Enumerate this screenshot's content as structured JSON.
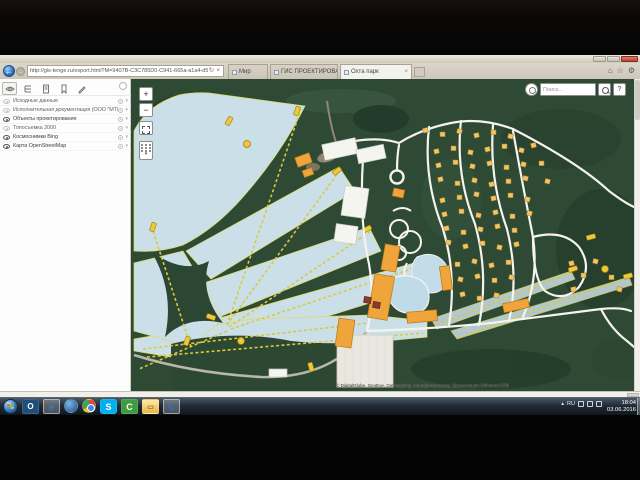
{
  "browser": {
    "back_icon": "←",
    "forward_icon": "→",
    "url": "http://gis-tenge.ru/export.html?M=9407B-C3C785D0-C941-665a-a1a4-d55b90ba77aa48bc65",
    "refresh_icon": "↻",
    "stop_icon": "×",
    "tabs": [
      {
        "label": "Мир"
      },
      {
        "label": "ГИС ПРОЕКТИРОВАНИЕ"
      },
      {
        "label": "Охта парк",
        "close_icon": "×"
      }
    ],
    "toolbar": {
      "home_icon": "⌂",
      "favorites_icon": "☆",
      "tools_icon": "⚙"
    }
  },
  "sidebar": {
    "tools": [
      {
        "name": "visibility"
      },
      {
        "name": "legend"
      },
      {
        "name": "documents"
      },
      {
        "name": "bookmarks"
      },
      {
        "name": "edit"
      }
    ],
    "chevron_icon": "▾",
    "layers": [
      {
        "label": "Исходные данные",
        "visible": false
      },
      {
        "label": "Исполнительная документация (ООО \"МТМ\")",
        "visible": false
      },
      {
        "label": "Объекты проектирования",
        "visible": true
      },
      {
        "label": "Топосъемка 2000",
        "visible": false
      },
      {
        "label": "Космоснимки Bing",
        "visible": true
      },
      {
        "label": "Карта OpenStreetMap",
        "visible": true
      }
    ]
  },
  "map": {
    "zoom_in_label": "+",
    "zoom_out_label": "−",
    "search_placeholder": "Поиск...",
    "help_label": "?",
    "attribution": "© DigitalGlobe, GeoEye, Getmapping, Аэрофотосъемка, Организации Области СПб",
    "colors": {
      "forest": "#2e4a35",
      "slope": "#cbdfe9",
      "slope_edge": "#e0dc5e",
      "lift": "#d8c93e",
      "station": "#f2c738",
      "building_orange": "#f0a43c",
      "cottage": "#f2c469",
      "road": "#f4f3ee",
      "water": "#bfdbe7"
    }
  },
  "taskbar": {
    "tray_language": "RU",
    "time": "18:04",
    "date": "03.06.2016"
  }
}
